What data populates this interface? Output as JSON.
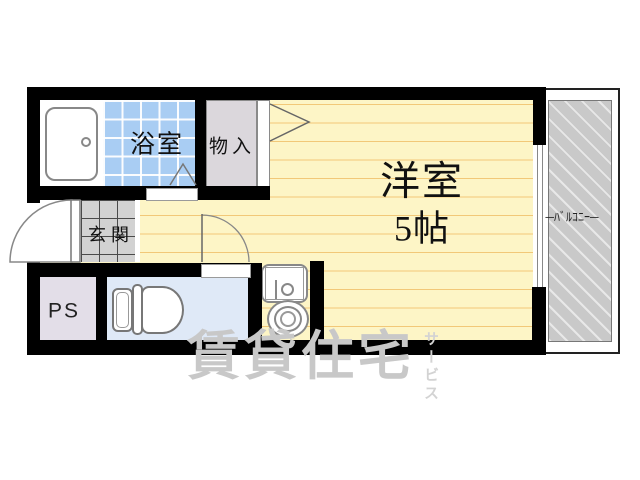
{
  "rooms": {
    "bathroom": {
      "label": "浴室"
    },
    "closet": {
      "label": "物入"
    },
    "entrance": {
      "label": "玄関"
    },
    "pipe_space": {
      "label": "PS"
    },
    "western_room": {
      "label": "洋室",
      "size": "5帖"
    },
    "balcony": {
      "label": "─ﾊﾞﾙｺﾆｰ─"
    }
  },
  "watermark": {
    "main": "賃貸住宅",
    "sub": "サービス"
  },
  "fixtures": [
    "bathtub-icon",
    "toilet-icon",
    "washbasin-icon",
    "washing-machine-icon",
    "door-swing-icon"
  ],
  "colors": {
    "wall": "#000000",
    "room_fill": "#fdf5c6",
    "room_line": "#f2c878",
    "tile_blue": "#a9cdf3",
    "closet_fill": "#dbd7dc",
    "genkan_fill": "#d2d2d2",
    "ps_fill": "#e3dee8",
    "toilet_fill": "#dfe9f7",
    "balcony_fill": "#c9c9c9",
    "watermark": "#c8c8c8"
  }
}
